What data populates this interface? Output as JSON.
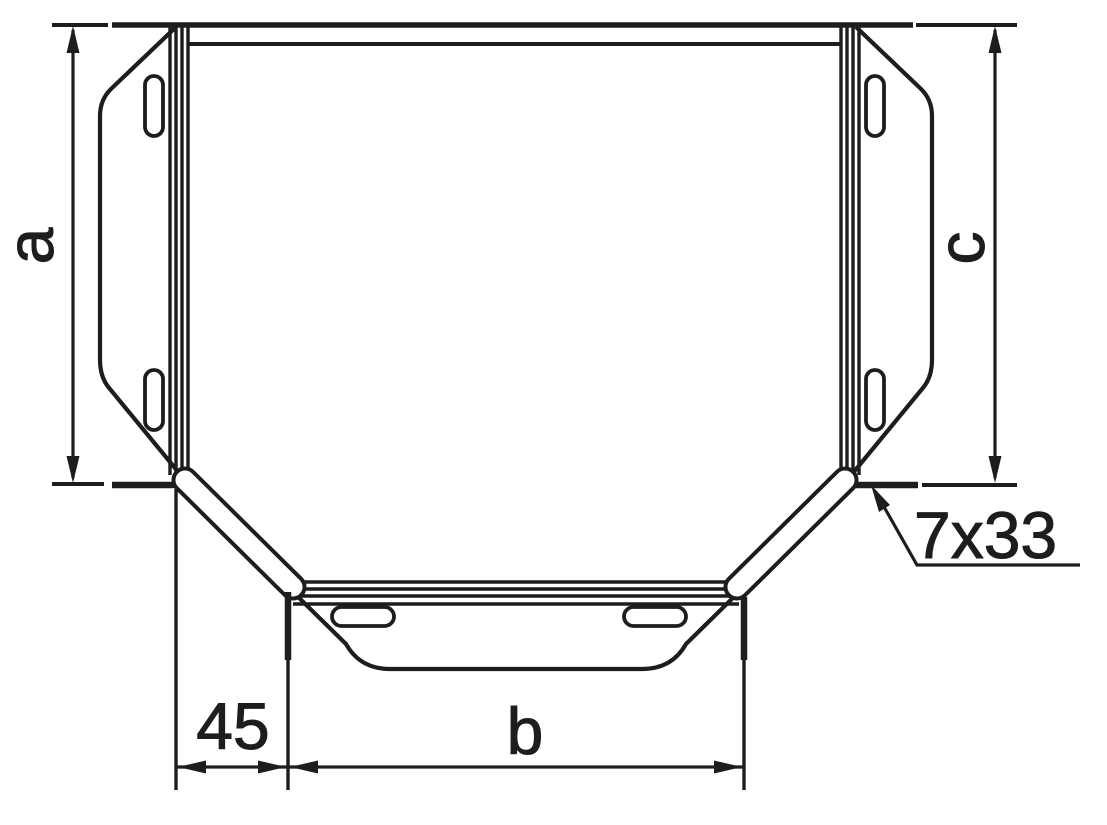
{
  "drawing": {
    "background_color": "#ffffff",
    "line_color": "#1d1d1b",
    "labels": {
      "dim_a": "a",
      "dim_c": "c",
      "dim_45": "45",
      "dim_b": "b",
      "slot_callout": "7x33"
    }
  }
}
